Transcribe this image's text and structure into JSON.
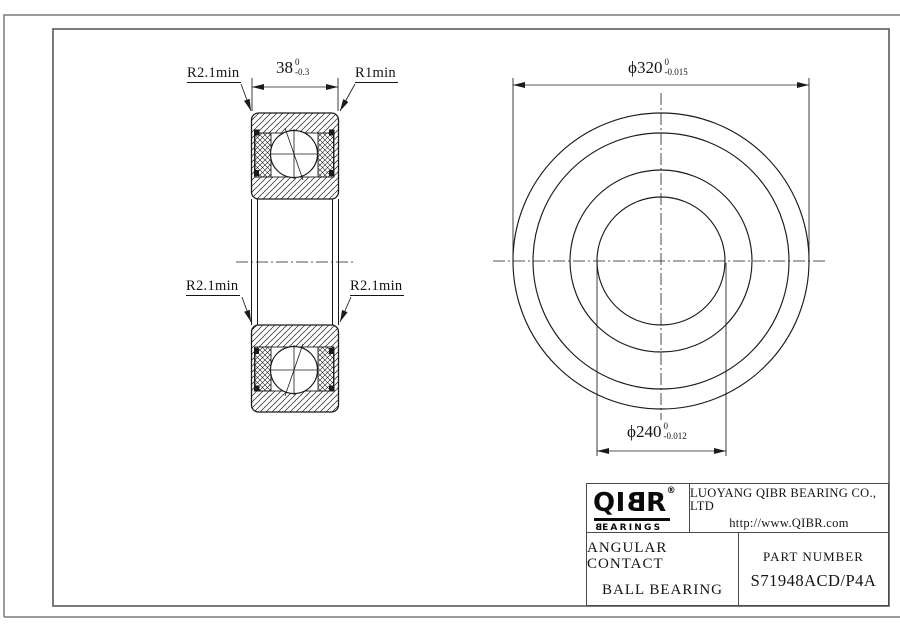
{
  "drawing": {
    "labels": {
      "top_left": "R2.1min",
      "top_right": "R1min",
      "mid_left": "R2.1min",
      "mid_right": "R2.1min"
    },
    "dim_width": {
      "value": "38",
      "tol_upper": "0",
      "tol_lower": "-0.3"
    },
    "dim_outer_diameter": {
      "value": "ϕ320",
      "tol_upper": "0",
      "tol_lower": "-0.015"
    },
    "dim_bore_diameter": {
      "value": "ϕ240",
      "tol_upper": "0",
      "tol_lower": "-0.012"
    }
  },
  "title_block": {
    "logo": {
      "part1": "QI",
      "part2": "B",
      "part3": "R",
      "registered": "®",
      "sub_first": "B",
      "sub_rest": "EARINGS"
    },
    "company_name": "LUOYANG QIBR BEARING CO., LTD",
    "website": "http://www.QIBR.com",
    "product_line1": "ANGULAR CONTACT",
    "product_line2": "BALL BEARING",
    "part_number_label": "PART NUMBER",
    "part_number": "S71948ACD/P4A"
  },
  "colors": {
    "line": "#1b1b1b",
    "border_outer": "#7a7a7a",
    "border_inner": "#5a5a5a"
  }
}
